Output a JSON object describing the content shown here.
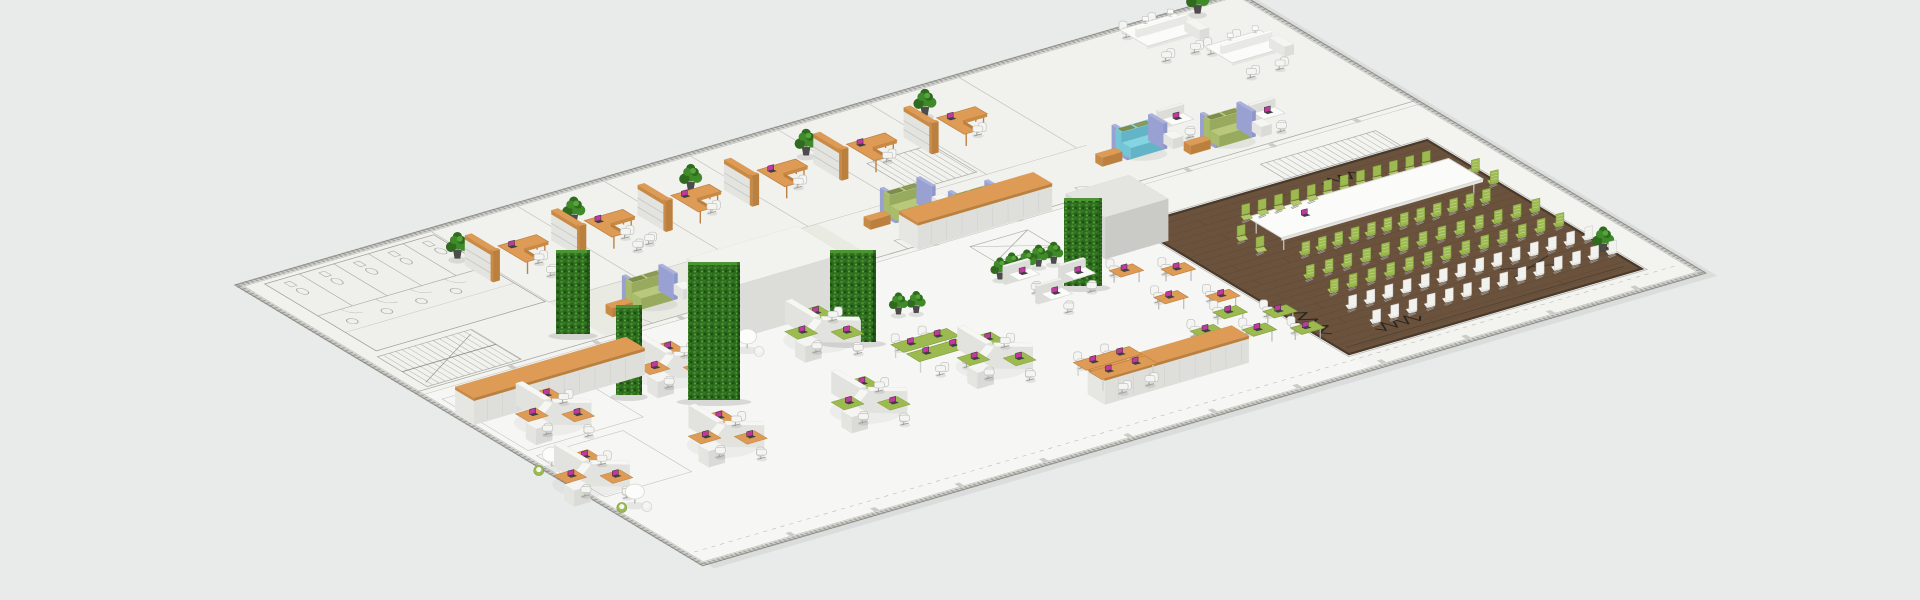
{
  "scene": {
    "type": "isometric-office-floorplan-3d-render",
    "canvas": {
      "width": 1920,
      "height": 600
    }
  },
  "palette": {
    "background": "#e9eaea",
    "floor": "#f3f3f0",
    "floor_top": "#f0f0ed",
    "floor_open": "#f6f6f4",
    "corridor": "#ececе9",
    "plan_line": "#a6a6a2",
    "plan_line_dark": "#8b8b87",
    "wall_light": "#c9c9c4",
    "wall_dash": "#9f9f9a",
    "orange": "#dd9b55",
    "orange_side": "#c98a45",
    "orange_dark": "#bb7f3e",
    "green": "#9cba4f",
    "green_seat": "#b2c66b",
    "green_dark": "#7e9c3a",
    "hedge_base": "#2e6b1f",
    "hedge_light": "#44912c",
    "hedge_deep": "#1d4f12",
    "wood": "#6a523c",
    "wood_line": "#564335",
    "wood_border": "#4a3a2b",
    "white_top": "#fbfbfa",
    "white_left": "#e8e8e4",
    "white_front": "#dededa",
    "gray_panel": "#d9d9d5",
    "chair_white": "#f4f4f2",
    "chair_stroke": "#c2c2be",
    "teal": "#84d4e2",
    "lavender": "#a9b2de",
    "sofa_green": "#b8c97c",
    "cushion": "#7d8d4b",
    "laptop_screen": "#c2389f",
    "laptop_body": "#3f3f45",
    "metal": "#a9a9a6",
    "pot": "#4c4c4a"
  },
  "projection": {
    "origin": [
      235,
      285
    ],
    "axis_a": [
      0.96,
      -0.28
    ],
    "axis_b": [
      0.858,
      0.515
    ],
    "length": 1045,
    "depth": 545
  },
  "architecture": {
    "bath_block": [
      22,
      10,
      198,
      140
    ],
    "stall_lines_a": [
      58,
      94,
      130,
      166
    ],
    "toilet_a": [
      40,
      76,
      112,
      148,
      184
    ],
    "sink_a": [
      40,
      76,
      112,
      148
    ],
    "stairs": [
      [
        16,
        148,
        114,
        206
      ],
      [
        585,
        82,
        652,
        135
      ],
      [
        860,
        233,
        980,
        262
      ]
    ],
    "office_divider_a": [
      200,
      290,
      380,
      470,
      562,
      656,
      750
    ],
    "office_front_b": 142,
    "corridor_b": 209,
    "door_arc_a": [
      232,
      326,
      420,
      514,
      608,
      702
    ],
    "column_step": 88,
    "xbox": [
      560,
      230,
      620,
      260
    ],
    "rooms": [
      [
        12,
        228,
        132,
        328
      ],
      [
        12,
        338,
        102,
        418
      ]
    ]
  },
  "wood_zone": {
    "rect": [
      700,
      265,
      1005,
      515
    ],
    "plank_step": 9
  },
  "furniture": {
    "offices": {
      "b": 66,
      "a_list": [
        215,
        305,
        395,
        485,
        578,
        672
      ],
      "guest_chairs": [
        0,
        1
      ]
    },
    "plants_top": [
      [
        187,
        50
      ],
      [
        310,
        48
      ],
      [
        430,
        50
      ],
      [
        552,
        48
      ],
      [
        682,
        41
      ],
      [
        992,
        12
      ]
    ],
    "plants_mid": [
      [
        543,
        284
      ],
      [
        557,
        282
      ],
      [
        571,
        284
      ],
      [
        585,
        282
      ],
      [
        599,
        284
      ],
      [
        431,
        291
      ],
      [
        445,
        296
      ]
    ],
    "white_pods": [
      [
        902,
        22
      ],
      [
        942,
        76
      ]
    ],
    "lounges": [
      {
        "a": 273,
        "b": 178,
        "type": "green"
      },
      {
        "a": 556,
        "b": 162,
        "type": "green"
      },
      {
        "a": 600,
        "b": 192,
        "type": "green",
        "compact": true
      },
      {
        "a": 792,
        "b": 168,
        "type": "teal"
      },
      {
        "a": 868,
        "b": 186,
        "type": "green"
      }
    ],
    "white_desks": [
      [
        829,
        148
      ],
      [
        900,
        175
      ]
    ],
    "hedge_walls": [
      [
        556,
        334,
        34,
        84
      ],
      [
        688,
        400,
        52,
        138
      ],
      [
        830,
        342,
        46,
        92
      ],
      [
        616,
        395,
        26,
        90
      ],
      [
        1064,
        286,
        38,
        88
      ]
    ],
    "core_boxes": [
      {
        "rect": [
          285,
          208,
          400,
          262
        ],
        "h": 54,
        "tone": "white"
      },
      {
        "rect": [
          640,
          252,
          706,
          298
        ],
        "h": 42,
        "tone": "gray"
      }
    ],
    "credenzas": [
      [
        4,
        252,
        182,
        274
      ],
      [
        520,
        192,
        660,
        214
      ],
      [
        470,
        468,
        620,
        488
      ]
    ],
    "clusters": [
      {
        "a": 60,
        "b": 300,
        "c": "orange"
      },
      {
        "a": 200,
        "b": 285,
        "c": "orange"
      },
      {
        "a": 15,
        "b": 395,
        "c": "orange"
      },
      {
        "a": 155,
        "b": 395,
        "c": "orange"
      },
      {
        "a": 345,
        "b": 295,
        "c": "green"
      },
      {
        "a": 295,
        "b": 405,
        "c": "green"
      },
      {
        "a": 435,
        "b": 395,
        "c": "green"
      }
    ],
    "round_tables": [
      [
        285,
        278
      ],
      [
        10,
        358
      ],
      [
        25,
        438
      ]
    ],
    "benches": [
      {
        "a": 375,
        "b": 345,
        "c": "green"
      },
      {
        "a": 482,
        "b": 438,
        "c": "orange"
      }
    ],
    "single_desks": [
      {
        "a": 616,
        "b": 330,
        "c": "orange"
      },
      {
        "a": 654,
        "b": 348,
        "c": "orange"
      },
      {
        "a": 616,
        "b": 382,
        "c": "orange"
      },
      {
        "a": 654,
        "b": 400,
        "c": "orange"
      },
      {
        "a": 640,
        "b": 424,
        "c": "green"
      },
      {
        "a": 676,
        "b": 442,
        "c": "green"
      },
      {
        "a": 602,
        "b": 440,
        "c": "green"
      },
      {
        "a": 640,
        "b": 458,
        "c": "green"
      },
      {
        "a": 676,
        "b": 474,
        "c": "green"
      }
    ],
    "white_stations": [
      [
        540,
        292
      ],
      [
        540,
        330
      ],
      [
        580,
        312
      ]
    ]
  },
  "townhall": {
    "table": [
      770,
      318,
      980,
      358
    ],
    "table_laptop": [
      812,
      338
    ],
    "rows": [
      {
        "b": 303,
        "a0": 782,
        "a1": 970,
        "n": 12,
        "c": "green",
        "dir": 1
      },
      {
        "b": 372,
        "a0": 782,
        "a1": 970,
        "n": 12,
        "c": "green",
        "dir": -1
      },
      {
        "b": 404,
        "a0": 758,
        "a1": 993,
        "n": 13,
        "c": "green",
        "dir": -1
      },
      {
        "b": 432,
        "a0": 758,
        "a1": 993,
        "n": 13,
        "c": "green",
        "dir": -1
      },
      {
        "b": 460,
        "a0": 752,
        "a1": 998,
        "n": 14,
        "c": "white",
        "dir": -1
      },
      {
        "b": 488,
        "a0": 752,
        "a1": 998,
        "n": 14,
        "c": "white",
        "dir": -1
      }
    ],
    "end_chairs": [
      {
        "a": 754,
        "b": 329,
        "dir": 1
      },
      {
        "a": 754,
        "b": 351,
        "dir": 1
      },
      {
        "a": 997,
        "b": 329,
        "dir": -1
      },
      {
        "a": 997,
        "b": 351,
        "dir": -1
      }
    ],
    "zigzags": [
      {
        "from": [
          712,
          432
        ],
        "to": [
          712,
          482
        ],
        "amp": 7,
        "n": 8
      },
      {
        "from": [
          748,
          492
        ],
        "to": [
          795,
          492
        ],
        "amp": 6,
        "n": 8
      },
      {
        "from": [
          880,
          282
        ],
        "to": [
          918,
          282
        ],
        "amp": 5,
        "n": 7
      }
    ],
    "cross": [
      [
        905,
        462,
        955,
        478
      ],
      [
        905,
        478,
        955,
        462
      ]
    ],
    "plant": [
      998,
      478
    ]
  },
  "counts": {
    "private_offices": 6,
    "hex_desk_clusters": 7,
    "conference_chairs_green": 28,
    "audience_rows_green": 2,
    "audience_rows_white": 2,
    "hedge_walls": 5,
    "lounge_sofas": 5
  }
}
